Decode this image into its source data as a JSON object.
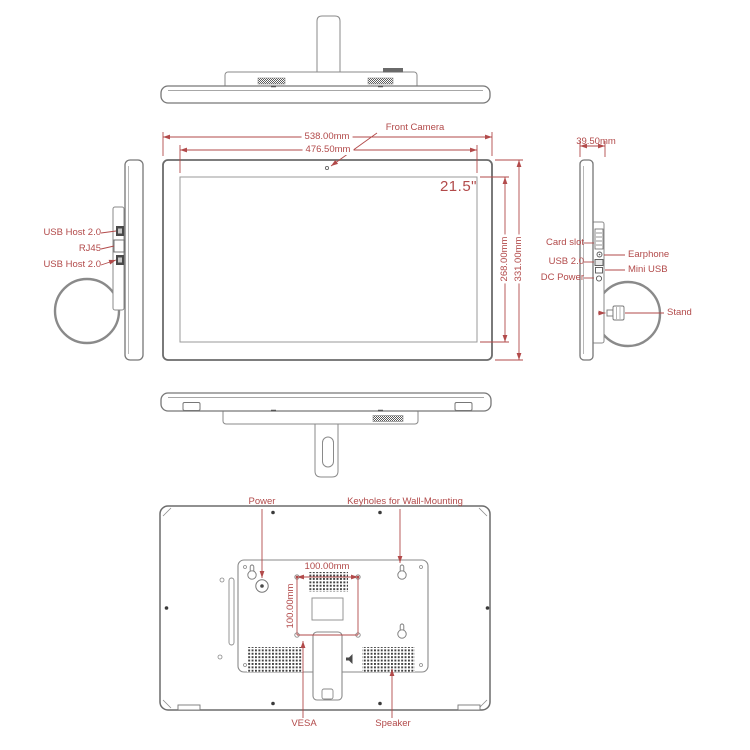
{
  "diagram": {
    "front": {
      "camera_label": "Front Camera",
      "size_label": "21.5\"",
      "overall_width": "538.00mm",
      "display_width": "476.50mm",
      "display_height": "268.00mm",
      "overall_height": "331.00mm"
    },
    "left_side": {
      "usb_host_top": "USB Host 2.0",
      "rj45": "RJ45",
      "usb_host_bottom": "USB Host 2.0"
    },
    "right_side": {
      "depth": "39.50mm",
      "card_slot": "Card slot",
      "earphone": "Earphone",
      "usb": "USB 2.0",
      "mini_usb": "Mini USB",
      "dc_power": "DC Power",
      "stand": "Stand"
    },
    "back": {
      "power": "Power",
      "keyholes": "Keyholes for Wall-Mounting",
      "vesa_width": "100.00mm",
      "vesa_height": "100.00mm",
      "vesa": "VESA",
      "speaker": "Speaker"
    },
    "colors": {
      "annotation": "#b24a4a",
      "line": "#8a8a8a"
    }
  }
}
